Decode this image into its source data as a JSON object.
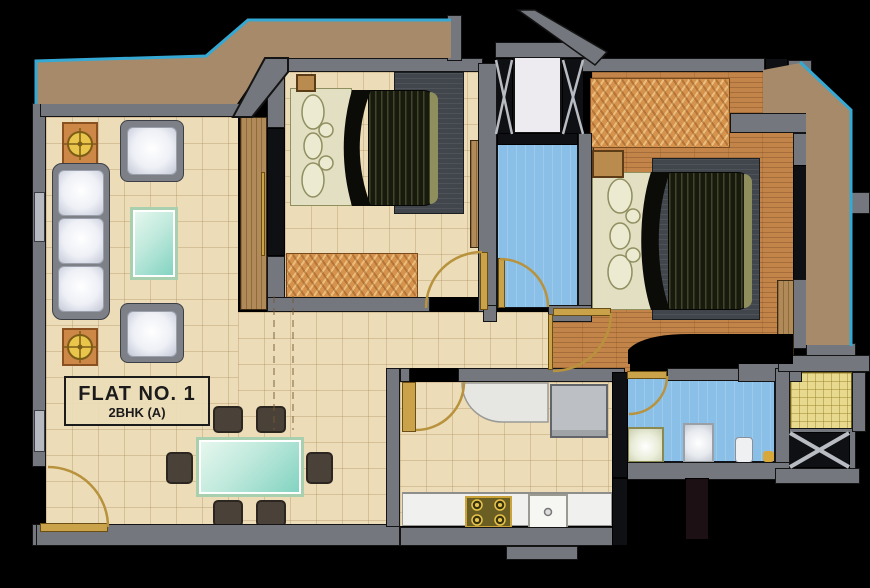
{
  "label": {
    "flat_no": "FLAT NO. 1",
    "flat_type": "2BHK (A)"
  },
  "palette": {
    "background": "#000000",
    "wall": "#74777d",
    "wall_outline": "#141414",
    "terrace": "#a68a69",
    "terrace_outline": "#35a9d4",
    "tile_floor": "#ecdcb8",
    "wood_floor": "#c28449",
    "bath_floor": "#8abfe7",
    "utility_floor": "#e7da8e",
    "kitchen_counter": "#f0f0ee",
    "door": "#c9a24a",
    "glass_table": "#bfe9dc",
    "sofa_cushion": "#eef0f6",
    "dining_chair": "#4a4139",
    "dresser_wood": "#d6934e",
    "mattress": "#171a0d",
    "rug": "#41464c",
    "lamp": "#e9c64b",
    "lift_shaft": "#edebef"
  },
  "icons": [
    "sofa",
    "armchair",
    "coffee-table",
    "table-lamp",
    "dining-table",
    "dining-chair",
    "double-bed",
    "pillow",
    "dresser",
    "wardrobe",
    "rug",
    "refrigerator",
    "gas-stove",
    "kitchen-sink",
    "washbasin",
    "shower-panel",
    "toilet",
    "lift-shaft",
    "air-duct",
    "door-swing",
    "balcony"
  ]
}
